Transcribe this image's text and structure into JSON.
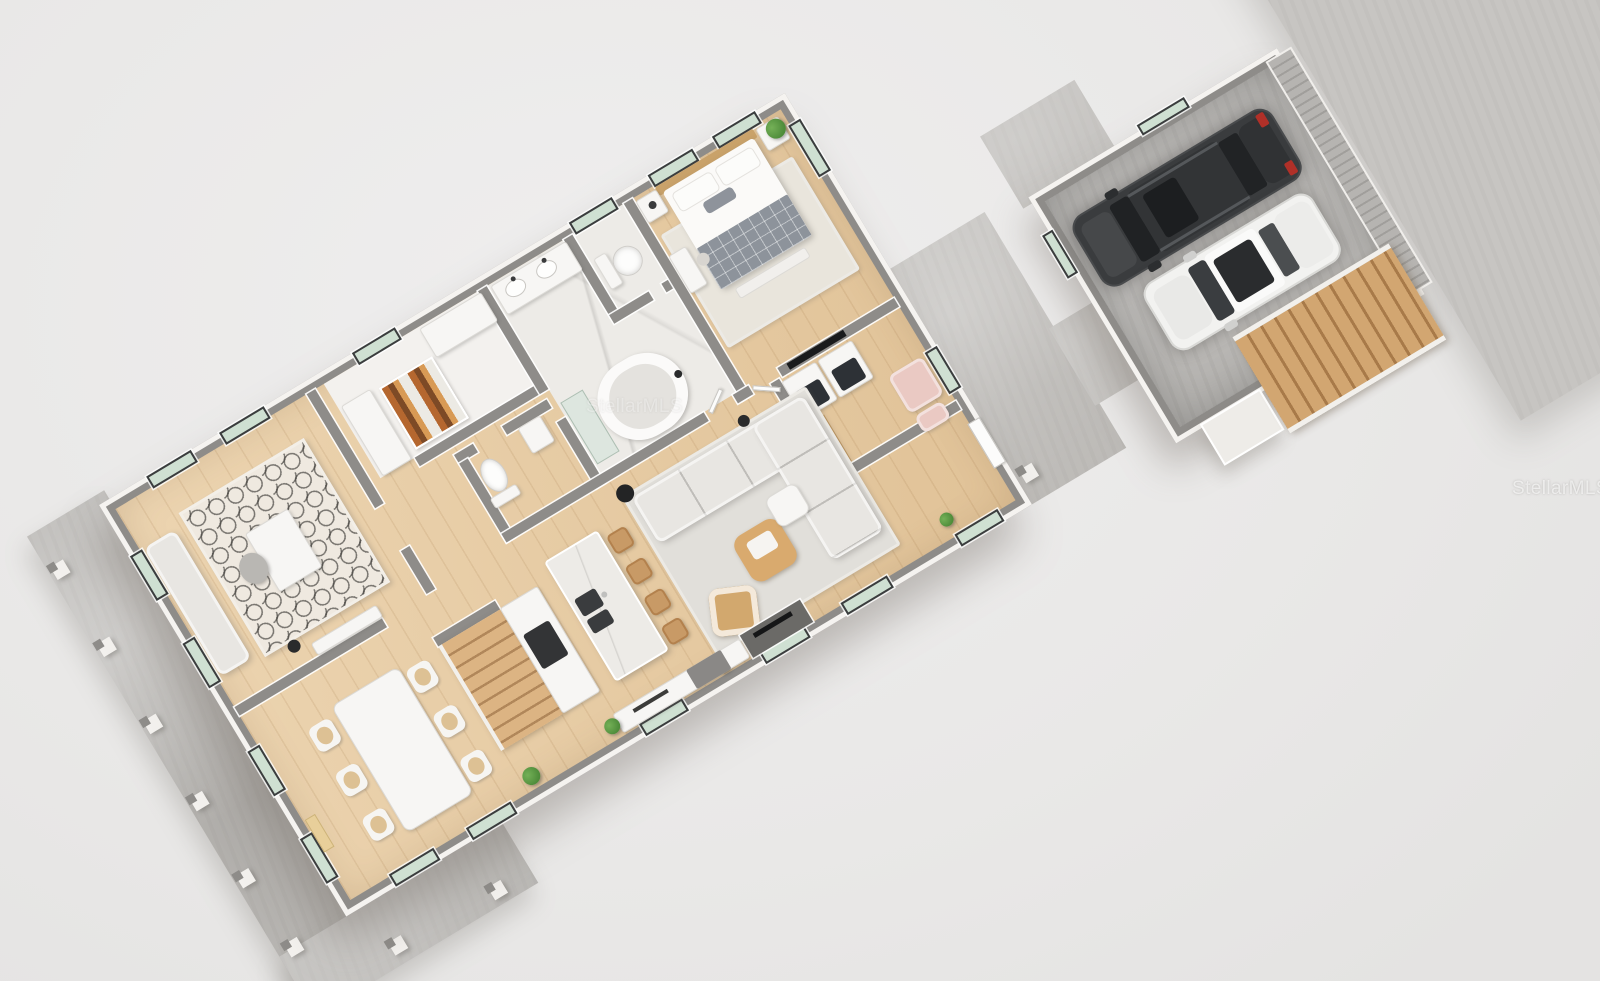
{
  "watermark": {
    "text": "StellarMLS"
  },
  "colors": {
    "background": "#e9e8e7",
    "wall_top": "#8e8c89",
    "wall_face": "#f5f3f0",
    "wood_floor": "#e9cda3",
    "concrete": "#c7c5c2",
    "garage_floor": "#b7b5b2",
    "marble": "#edebe7",
    "window_glass": "#cfe0d2",
    "stairs_wood": "#d2a671",
    "suv_body": "#3a3c3e",
    "car_body": "#f2f2f0",
    "plant_green": "#4e8c3a",
    "accent_pink": "#eac9c3",
    "rug": "#e1dfda"
  },
  "floor_plan": {
    "view": "3d-top-down-dollhouse-render",
    "rotation_deg": -31,
    "rooms": [
      {
        "name": "primary-bedroom",
        "furniture": [
          "double-bed",
          "nightstands",
          "bench",
          "area-rug",
          "wall-tv",
          "vanity-desk",
          "plant"
        ]
      },
      {
        "name": "primary-bathroom",
        "furniture": [
          "double-vanity",
          "freestanding-tub",
          "walk-in-shower"
        ]
      },
      {
        "name": "water-closet",
        "furniture": [
          "toilet"
        ]
      },
      {
        "name": "powder-room",
        "furniture": [
          "toilet",
          "sink"
        ]
      },
      {
        "name": "walk-in-closet",
        "furniture": [
          "color-shelving",
          "cabinets"
        ]
      },
      {
        "name": "office",
        "furniture": [
          "desk",
          "chair",
          "daybed",
          "trellis-rug",
          "floor-lamp",
          "console"
        ]
      },
      {
        "name": "laundry-room",
        "furniture": [
          "washer",
          "dryer",
          "storage-shelves",
          "pink-armchair",
          "pink-ottoman"
        ]
      },
      {
        "name": "living-room",
        "furniture": [
          "sectional-sofa",
          "coffee-table",
          "armchair",
          "ottoman",
          "area-rug",
          "floor-lamp",
          "media-wall"
        ]
      },
      {
        "name": "kitchen",
        "furniture": [
          "marble-island",
          "bar-stools",
          "range-counter",
          "sideboard"
        ]
      },
      {
        "name": "dining-area",
        "furniture": [
          "dining-table",
          "six-chairs",
          "plants",
          "wall-art"
        ]
      },
      {
        "name": "staircase",
        "furniture": [
          "wood-treads"
        ]
      }
    ],
    "exterior": [
      "front-porch-with-posts",
      "rear-patio",
      "walkway-to-garage",
      "driveway",
      "exterior-wood-stairs"
    ],
    "garage": {
      "cars": [
        {
          "type": "suv",
          "color": "dark-gray"
        },
        {
          "type": "hatchback",
          "color": "white"
        }
      ],
      "features": [
        "ribbed-garage-door",
        "windows",
        "entry-landing"
      ]
    }
  }
}
